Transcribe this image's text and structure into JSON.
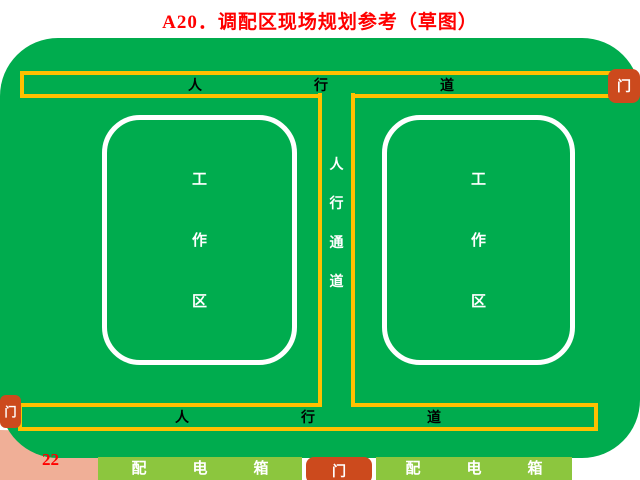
{
  "page": {
    "title": "A20．调配区现场规划参考（草图）",
    "page_number": "22"
  },
  "colors": {
    "site_green": "#00ac4e",
    "walkway_yellow": "#ffc000",
    "gate_orange": "#cc4a1d",
    "power_box_green": "#8cc63e",
    "corner_salmon": "#f0af97",
    "title_red": "#ff0000",
    "work_area_outline": "#ffffff"
  },
  "diagram": {
    "top_walkway": {
      "label": "人行道",
      "chars": [
        "人",
        "行",
        "道"
      ]
    },
    "bottom_walkway": {
      "label": "人行道",
      "chars": [
        "人",
        "行",
        "道"
      ]
    },
    "center_aisle": {
      "label": "人行通道",
      "chars": [
        "人",
        "行",
        "通",
        "道"
      ]
    },
    "left_work_area": {
      "label": "工作区",
      "chars": [
        "工",
        "作",
        "区"
      ]
    },
    "right_work_area": {
      "label": "工作区",
      "chars": [
        "工",
        "作",
        "区"
      ]
    },
    "gates": {
      "top_right": "门",
      "bottom_left": "门",
      "bottom_center": "门"
    },
    "left_power_box": {
      "label": "配电箱",
      "chars": [
        "配",
        "电",
        "箱"
      ]
    },
    "right_power_box": {
      "label": "配电箱",
      "chars": [
        "配",
        "电",
        "箱"
      ]
    }
  }
}
